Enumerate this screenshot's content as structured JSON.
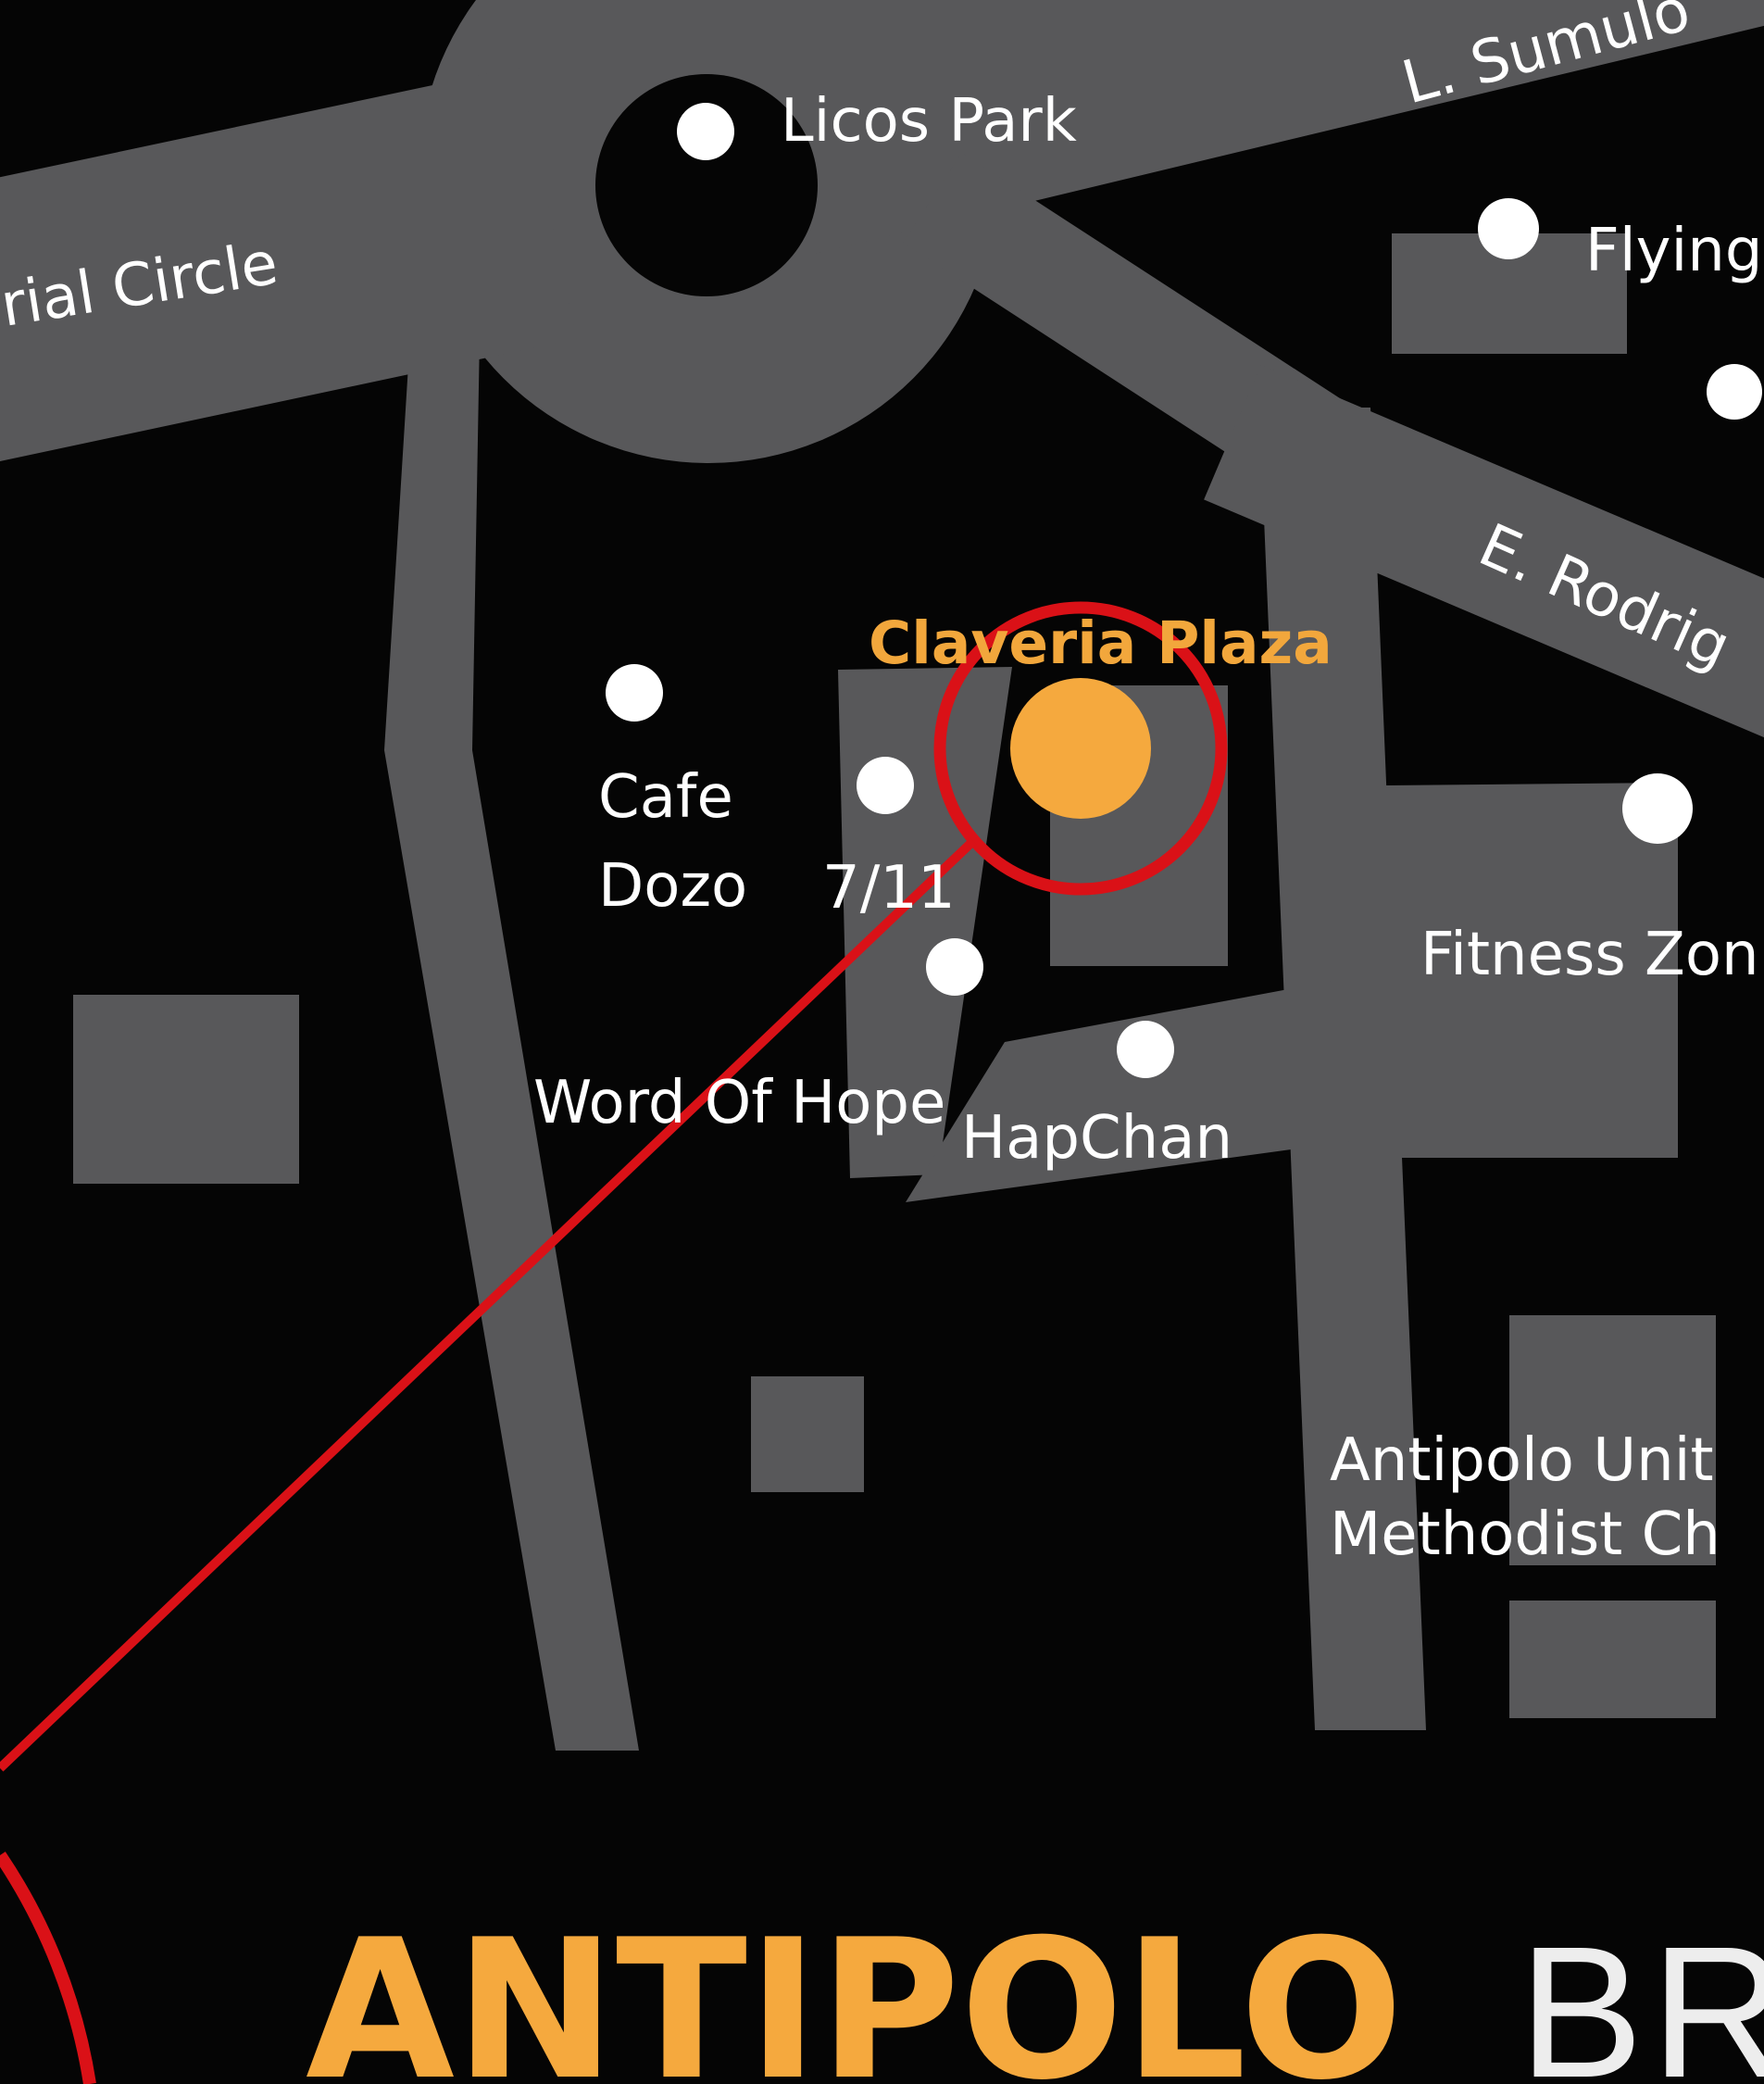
{
  "map": {
    "colors": {
      "background": "#050505",
      "road_gray": "#58585a",
      "marker_white": "#ffffff",
      "accent_orange": "#f5a93e",
      "highlight_red": "#da1117",
      "title_secondary_gray": "#ededed"
    },
    "roads": {
      "memorial_circle": "rial Circle",
      "l_sumulong": "L. Sumulo",
      "e_rodriguez": "E. Rodrig"
    },
    "pois": {
      "licos_park": {
        "label": "Licos Park"
      },
      "flying": {
        "label": "Flying"
      },
      "claveria_plaza": {
        "label": "Claveria Plaza"
      },
      "cafe_dozo": {
        "line1": "Cafe",
        "line2": "Dozo"
      },
      "seven_eleven": {
        "label": "7/11"
      },
      "word_of_hope": {
        "label": "Word Of Hope"
      },
      "hapchan": {
        "label": "HapChan"
      },
      "fitness_zone": {
        "label": "Fitness Zon"
      },
      "methodist_church": {
        "line1": "Antipolo Unit",
        "line2": "Methodist Ch"
      }
    },
    "title": {
      "primary": "ANTIPOLO",
      "secondary": "BR"
    }
  }
}
